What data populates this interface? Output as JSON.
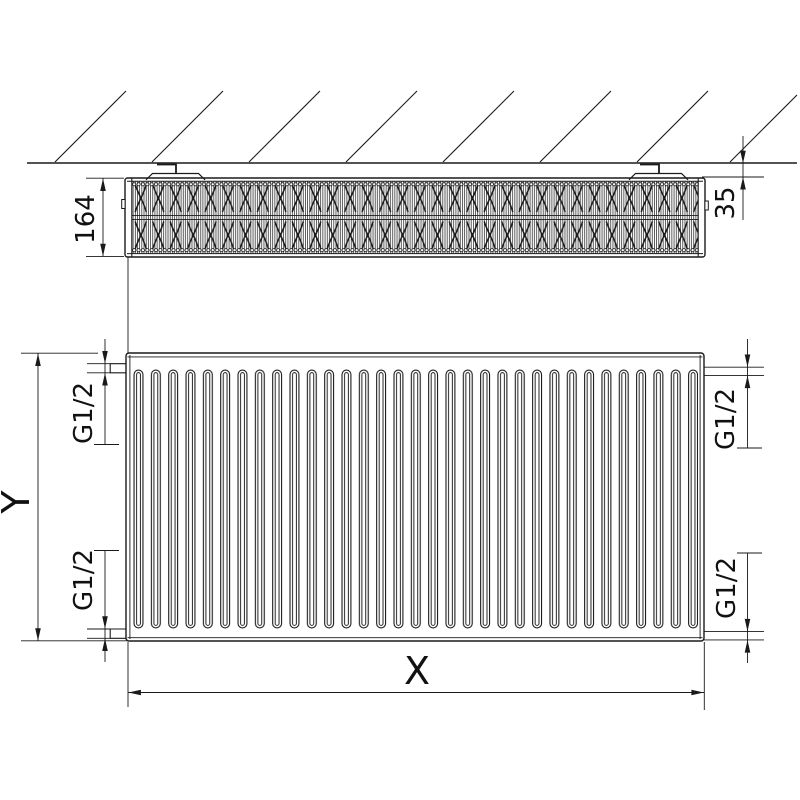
{
  "drawing": {
    "colors": {
      "line": "#1a1a1a",
      "background": "#ffffff",
      "text": "#111111"
    },
    "top_view": {
      "depth_label": "164",
      "wall_gap_label": "35"
    },
    "front_view": {
      "width_label": "X",
      "height_label": "Y",
      "connections": {
        "top_left": "G1/2",
        "top_right": "G1/2",
        "bottom_left": "G1/2",
        "bottom_right": "G1/2"
      }
    }
  }
}
